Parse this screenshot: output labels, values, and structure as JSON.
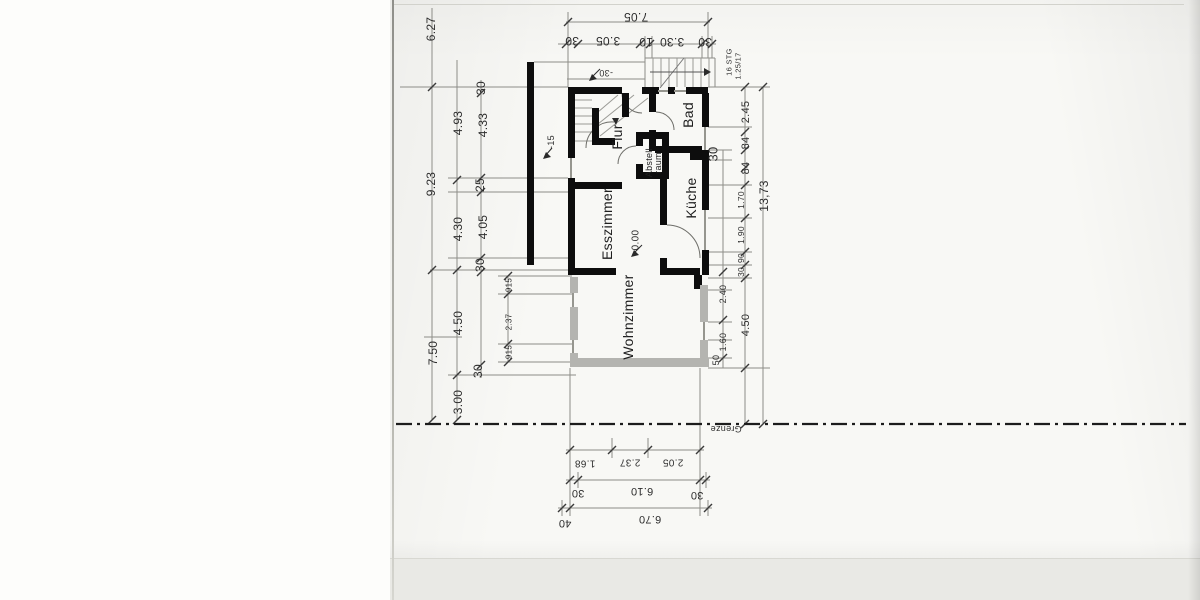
{
  "annotations": {
    "level": "0.00",
    "offset30": "-30",
    "offset15": "-15",
    "stairs_line1": "16 STG",
    "stairs_line2": "1.25/17",
    "boundary": "Grenze"
  },
  "rooms": [
    {
      "label": "Flur",
      "x": 617,
      "y": 137,
      "fs": 14
    },
    {
      "label": "Bad",
      "x": 688,
      "y": 115,
      "fs": 14
    },
    {
      "label": "Küche",
      "x": 691,
      "y": 198,
      "fs": 14
    },
    {
      "label": "Esszimmer",
      "x": 607,
      "y": 224,
      "fs": 14
    },
    {
      "label": "Wohnzimmer",
      "x": 628,
      "y": 317,
      "fs": 14
    },
    {
      "label": "Abstell-",
      "x": 649,
      "y": 161,
      "fs": 9
    },
    {
      "label": "raum",
      "x": 658,
      "y": 163,
      "fs": 9
    }
  ],
  "dim_groups": [
    {
      "name": "top-row-outer",
      "rot": 180,
      "fs": 12,
      "items": [
        {
          "t": "7.05",
          "x": 636,
          "y": 17
        }
      ]
    },
    {
      "name": "top-row-inner",
      "rot": 180,
      "fs": 12,
      "items": [
        {
          "t": "30",
          "x": 572,
          "y": 41
        },
        {
          "t": "3.05",
          "x": 608,
          "y": 41
        },
        {
          "t": "10",
          "x": 646,
          "y": 42
        },
        {
          "t": "3.30",
          "x": 672,
          "y": 42
        },
        {
          "t": "30",
          "x": 705,
          "y": 42
        }
      ]
    },
    {
      "name": "left-outer",
      "rot": -90,
      "fs": 12,
      "items": [
        {
          "t": "6.27",
          "x": 431,
          "y": 29
        },
        {
          "t": "9.23",
          "x": 431,
          "y": 184
        },
        {
          "t": "7.50",
          "x": 433,
          "y": 353
        }
      ]
    },
    {
      "name": "left-middle",
      "rot": -90,
      "fs": 12,
      "items": [
        {
          "t": "4.93",
          "x": 458,
          "y": 123
        },
        {
          "t": "4.30",
          "x": 458,
          "y": 229
        },
        {
          "t": "4.50",
          "x": 458,
          "y": 323
        },
        {
          "t": "3.00",
          "x": 458,
          "y": 402
        }
      ]
    },
    {
      "name": "left-inner",
      "rot": -90,
      "fs": 12,
      "items": [
        {
          "t": "30",
          "x": 481,
          "y": 88
        },
        {
          "t": "4.33",
          "x": 483,
          "y": 125
        },
        {
          "t": "25",
          "x": 480,
          "y": 185
        },
        {
          "t": "4.05",
          "x": 483,
          "y": 227
        },
        {
          "t": "30",
          "x": 480,
          "y": 265
        },
        {
          "t": "30",
          "x": 478,
          "y": 371
        }
      ]
    },
    {
      "name": "left-small",
      "rot": -90,
      "fs": 8,
      "items": [
        {
          "t": "915",
          "x": 509,
          "y": 285
        },
        {
          "t": "2.37",
          "x": 509,
          "y": 322
        },
        {
          "t": "915",
          "x": 509,
          "y": 352
        }
      ]
    },
    {
      "name": "right-inner",
      "rot": -90,
      "fs": 9,
      "items": [
        {
          "t": "2.40",
          "x": 723,
          "y": 294
        },
        {
          "t": "1.60",
          "x": 723,
          "y": 342
        },
        {
          "t": "50",
          "x": 716,
          "y": 360
        }
      ]
    },
    {
      "name": "right-step",
      "rot": -90,
      "fs": 13,
      "items": [
        {
          "t": "30",
          "x": 713,
          "y": 154
        }
      ]
    },
    {
      "name": "right-chain-large",
      "rot": -90,
      "fs": 11,
      "items": [
        {
          "t": "2.45",
          "x": 746,
          "y": 112
        },
        {
          "t": "84",
          "x": 746,
          "y": 143
        },
        {
          "t": "84",
          "x": 746,
          "y": 168
        },
        {
          "t": "4.50",
          "x": 746,
          "y": 325
        }
      ]
    },
    {
      "name": "right-chain-small",
      "rot": -90,
      "fs": 8.5,
      "items": [
        {
          "t": "1.70",
          "x": 741,
          "y": 200
        },
        {
          "t": "1.90",
          "x": 741,
          "y": 235
        },
        {
          "t": "90",
          "x": 741,
          "y": 258
        },
        {
          "t": "30",
          "x": 741,
          "y": 272
        }
      ]
    },
    {
      "name": "right-total",
      "rot": -90,
      "fs": 12,
      "items": [
        {
          "t": "13,73",
          "x": 764,
          "y": 196
        }
      ]
    },
    {
      "name": "bottom-row-1",
      "rot": 180,
      "fs": 10,
      "items": [
        {
          "t": "1.68",
          "x": 585,
          "y": 463
        },
        {
          "t": "2.37",
          "x": 630,
          "y": 462
        },
        {
          "t": "2.05",
          "x": 673,
          "y": 462
        }
      ]
    },
    {
      "name": "bottom-row-2",
      "rot": 180,
      "fs": 11,
      "items": [
        {
          "t": "30",
          "x": 578,
          "y": 493
        },
        {
          "t": "6.10",
          "x": 642,
          "y": 491
        },
        {
          "t": "30",
          "x": 697,
          "y": 495
        }
      ]
    },
    {
      "name": "bottom-row-3",
      "rot": 180,
      "fs": 11,
      "items": [
        {
          "t": "40",
          "x": 565,
          "y": 523
        },
        {
          "t": "6.70",
          "x": 650,
          "y": 519
        }
      ]
    }
  ],
  "colors": {
    "wall": "#0d0d0d",
    "planned_wall_gray": "#b4b4b0",
    "line": "#8d8d88",
    "text": "#2e2e2e"
  }
}
